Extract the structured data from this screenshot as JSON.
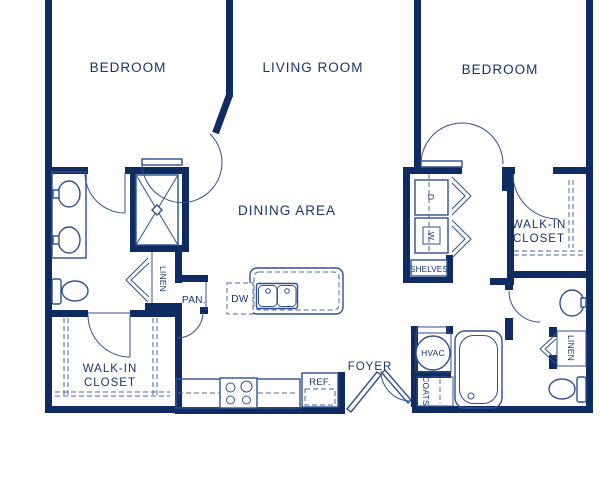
{
  "plan": {
    "type": "apartment-floor-plan",
    "colors": {
      "wall": "#0e2c62",
      "fixture_line": "#30508f",
      "dashed_line": "#4a67a0",
      "label_text": "#16356e",
      "background": "#ffffff"
    }
  },
  "rooms": {
    "bedroom_left": "BEDROOM",
    "living_room": "LIVING ROOM",
    "bedroom_right": "BEDROOM",
    "dining_area": "DINING AREA",
    "foyer": "FOYER",
    "wic_left": {
      "line1": "WALK-IN",
      "line2": "CLOSET"
    },
    "wic_right": {
      "line1": "WALK-IN",
      "line2": "CLOSET"
    }
  },
  "fixtures": {
    "linen_left": "LINEN",
    "linen_right": "LINEN",
    "pantry": "PAN.",
    "dishwasher": "DW",
    "shelves": "SHELVES",
    "hvac": "HVAC",
    "coats": "COATS",
    "refrigerator": "REF.",
    "washer": "W",
    "dryer": "D"
  }
}
